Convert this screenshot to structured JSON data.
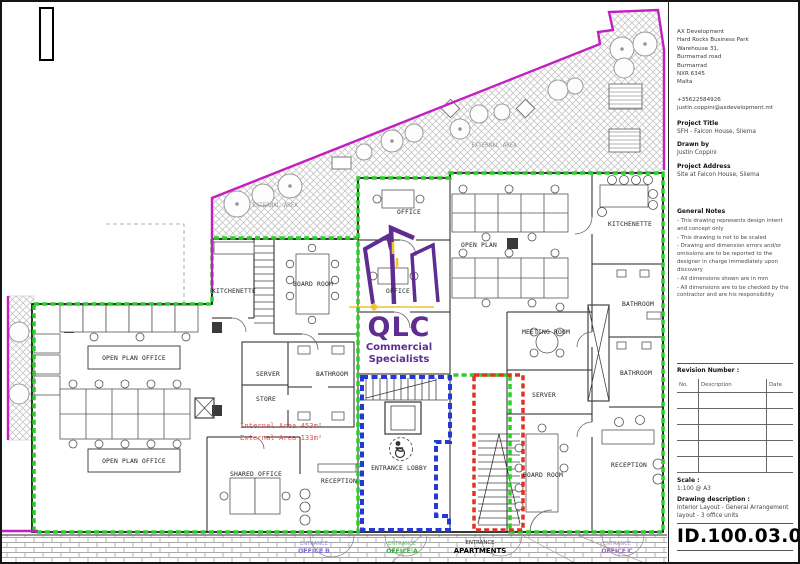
{
  "title_block": {
    "company": {
      "name": "AX Development",
      "address_lines": [
        "Hard Rocks Business Park",
        "Warehouse 31,",
        "Burmarrad road",
        "Burmarrad",
        "NXR 6345",
        "Malta"
      ],
      "phone": "+35622584926",
      "email": "justin.coppini@axdevelopment.mt"
    },
    "project_title_label": "Project Title",
    "project_title": "SFH - Falcon House, Sliema",
    "drawn_by_label": "Drawn by",
    "drawn_by": "Justin Coppini",
    "project_address_label": "Project Address",
    "project_address": "Site at Falcon House, Sliema",
    "general_notes_label": "General Notes",
    "general_notes": [
      "- This drawing represents design intent and concept only",
      "- This drawing is not to be scaled",
      "- Drawing and dimension errors and/or omissions are to be reported to the designer in charge immediately upon discovery",
      "- All dimensions shown are in mm",
      "- All dimensions are to be checked by the contractor and are his responsibility"
    ],
    "revision_label": "Revision Number :",
    "revision_columns": [
      "No.",
      "Description",
      "Date"
    ],
    "scale_label": "Scale :",
    "scale_value": "1:100 @ A3",
    "drawing_description_label": "Drawing description :",
    "drawing_description": "Interior Layout - General Arrangement layout - 3 office units",
    "drawing_id": "ID.100.03.00"
  },
  "plan": {
    "rooms": {
      "open_plan_office_1": "OPEN PLAN OFFICE",
      "open_plan_office_2": "OPEN PLAN OFFICE",
      "kitchenette_left": "KITCHENETTE",
      "board_room_left": "BOARD ROOM",
      "server_left": "SERVER",
      "bathroom_left": "BATHROOM",
      "store": "STORE",
      "shared_office": "SHARED OFFICE",
      "reception_left": "RECEPTION",
      "office_upper": "OFFICE",
      "office_lower": "OFFICE",
      "entrance_lobby": "ENTRANCE LOBBY",
      "open_plan_right": "OPEN PLAN",
      "kitchenette_right": "KITCHENETTE",
      "bathroom_top_right": "BATHROOM",
      "meeting_room": "MEETING ROOM",
      "server_right": "SERVER",
      "bathroom_mid_right": "BATHROOM",
      "board_room_right": "BOARD ROOM",
      "reception_right": "RECEPTION"
    },
    "annotations": {
      "internal_area": "Internal Area 453m²",
      "external_area": "External Area 133m²",
      "external_area_label_left": "EXTERNAL AREA",
      "external_area_label_right": "EXTERNAL AREA"
    },
    "entrances": {
      "apartments_line1": "ENTRANCE",
      "apartments_line2": "APARTMENTS",
      "office_a_line1": "ENTRANCE",
      "office_a_line2": "OFFICE A",
      "office_b_line1": "ENTRANCE",
      "office_b_line2": "OFFICE B",
      "office_c_line1": "ENTRANCE",
      "office_c_line2": "OFFICE C"
    }
  },
  "logo": {
    "acronym": "QLC",
    "tagline_line1": "Commercial",
    "tagline_line2": "Specialists"
  },
  "colors": {
    "unit_boundary_green": "#28cf28",
    "lobby_boundary_blue": "#2438d6",
    "stair_boundary_red": "#e03226",
    "site_boundary_magenta": "#c21fc2",
    "area_text_red": "#d9534f",
    "logo_purple": "#5f2c91",
    "logo_yellow": "#f2c230"
  }
}
